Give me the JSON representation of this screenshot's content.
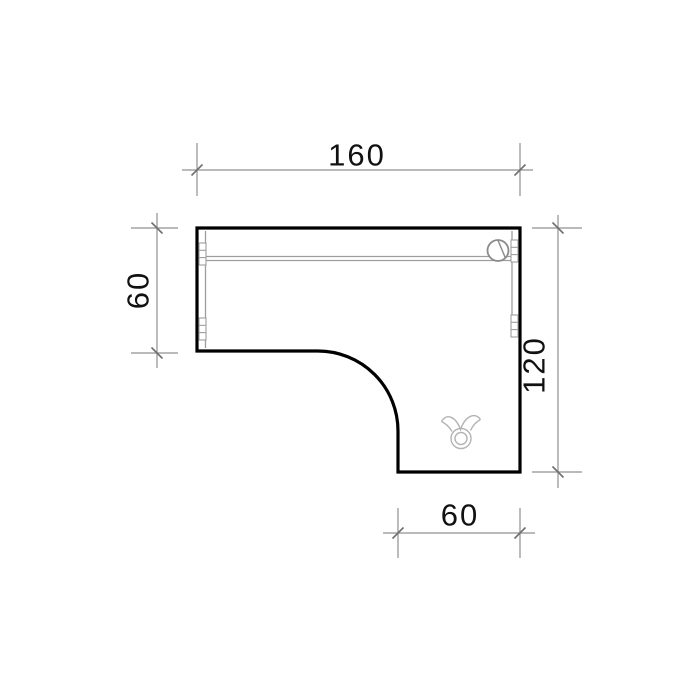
{
  "drawing": {
    "kind": "furniture-plan-l-shaped-desk-top-view",
    "dimensions": {
      "top": {
        "value": "160"
      },
      "left": {
        "value": "60"
      },
      "right": {
        "value": "120"
      },
      "bottom": {
        "value": "60"
      }
    },
    "icons": {
      "grommet": "cable-grommet-icon",
      "bull_symbol": "taurus-symbol-icon",
      "connectors": "edge-connector-icon"
    },
    "colors": {
      "outline": "#000000",
      "dimension_lines": "#909090",
      "tick_marks": "#6f6f6f",
      "detail_lines": "#9e9e9e",
      "symbol_lines": "#b3b3b3",
      "label_text": "#111111",
      "background": "#ffffff"
    }
  }
}
